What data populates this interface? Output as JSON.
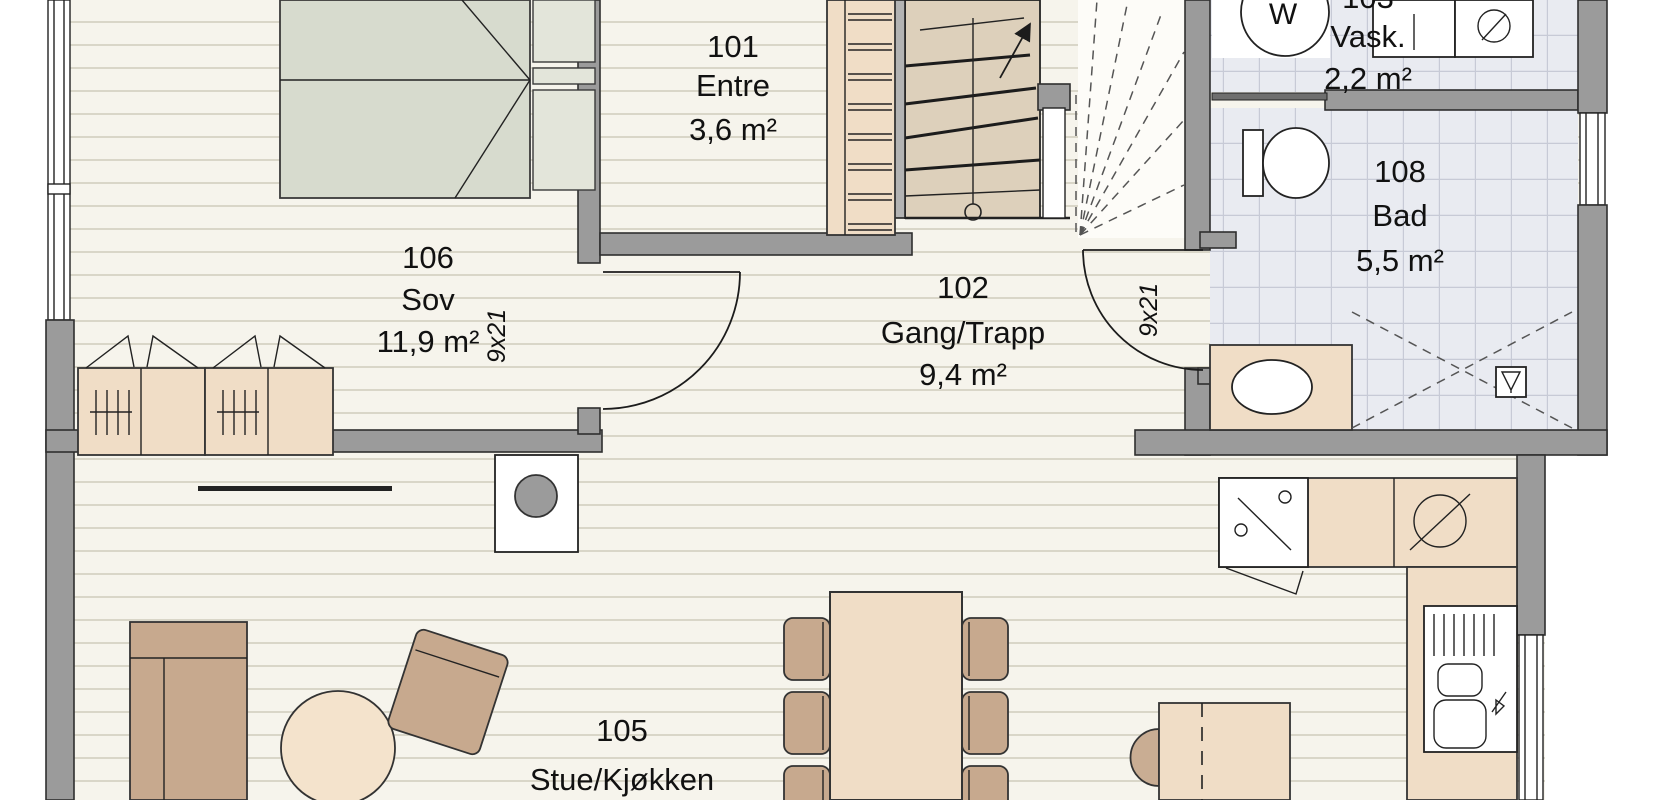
{
  "plan_title": "First floor plan",
  "rooms": {
    "entre": {
      "number": "101",
      "name": "Entre",
      "area": "3,6 m²"
    },
    "gang": {
      "number": "102",
      "name": "Gang/Trapp",
      "area": "9,4 m²"
    },
    "vask": {
      "number": "103",
      "name": "Vask.",
      "area": "2,2 m²"
    },
    "stue": {
      "number": "105",
      "name": "Stue/Kjøkken",
      "area": "34,3 m²"
    },
    "sov": {
      "number": "106",
      "name": "Sov",
      "area": "11,9 m²"
    },
    "bad": {
      "number": "108",
      "name": "Bad",
      "area": "5,5 m²"
    }
  },
  "doors": {
    "sov_door_size": "9x21",
    "bad_door_size": "9x21"
  },
  "appliances": {
    "washing_machine_label": "W"
  },
  "colors": {
    "wall_gray": "#9b9b9b",
    "wood_floor": "#f6f4ec",
    "wood_plank_line": "#d9d6c8",
    "tile_floor": "#e9ebf1",
    "tile_line": "#c7cad6",
    "furniture_beige": "#f0ddc6",
    "furniture_tan": "#c7a98e",
    "bed_green_gray": "#d7dbce",
    "line_dark": "#222222"
  }
}
